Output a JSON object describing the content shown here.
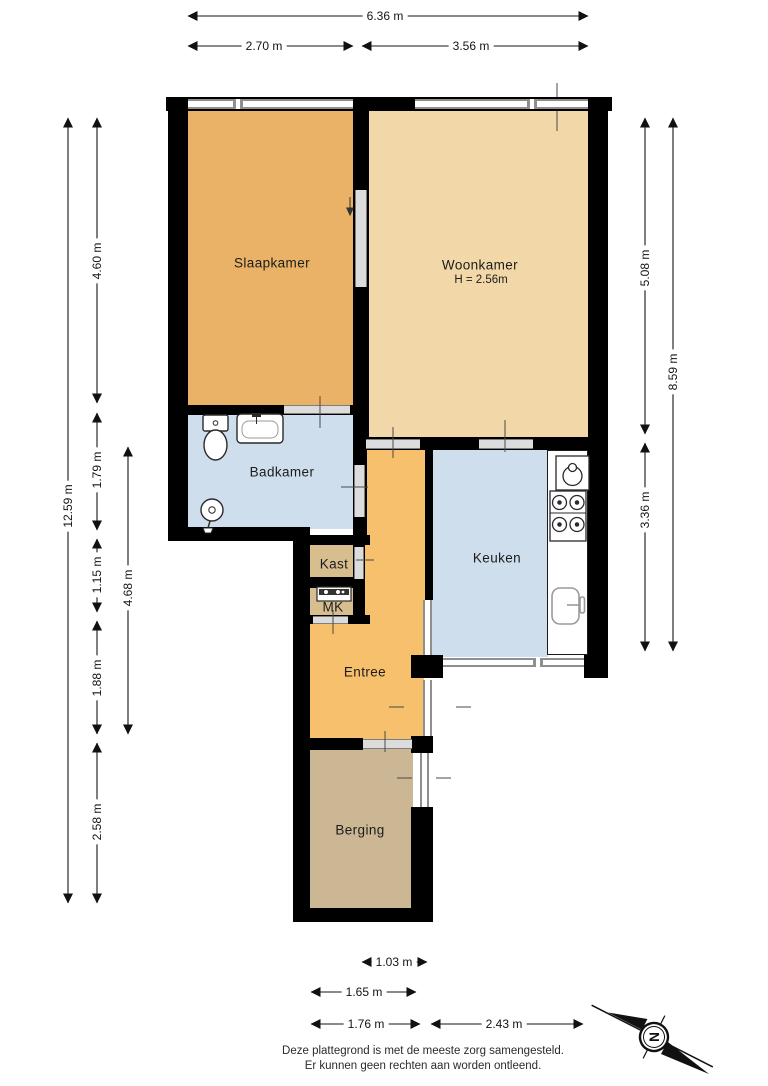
{
  "plan": {
    "rooms": {
      "slaapkamer": "Slaapkamer",
      "woonkamer": "Woonkamer",
      "woonkamer_height": "H = 2.56m",
      "badkamer": "Badkamer",
      "kast": "Kast",
      "mk": "MK",
      "keuken": "Keuken",
      "entree": "Entree",
      "berging": "Berging"
    },
    "dimensions": {
      "top_total": "6.36 m",
      "top_left": "2.70 m",
      "top_right": "3.56 m",
      "left_total": "12.59 m",
      "left_1": "4.60 m",
      "left_2": "1.79 m",
      "left_3": "1.15 m",
      "left_4": "1.88 m",
      "left_5": "2.58 m",
      "left_inner": "4.68 m",
      "right_1": "5.08 m",
      "right_2": "3.36 m",
      "right_total": "8.59 m",
      "bottom_1": "1.03 m",
      "bottom_2": "1.65 m",
      "bottom_3": "1.76 m",
      "bottom_4": "2.43 m"
    },
    "compass": "N",
    "disclaimer_line1": "Deze plattegrond is met de meeste zorg samengesteld.",
    "disclaimer_line2": "Er kunnen geen rechten aan worden ontleend.",
    "colors": {
      "slaapkamer": "#e9b266",
      "woonkamer": "#f2d8a9",
      "badkamer": "#cfdeed",
      "keuken": "#cfdeed",
      "entree": "#f6c06c",
      "kast_mk": "#d8bd8e",
      "berging": "#cbb794",
      "wall": "#000000"
    }
  }
}
